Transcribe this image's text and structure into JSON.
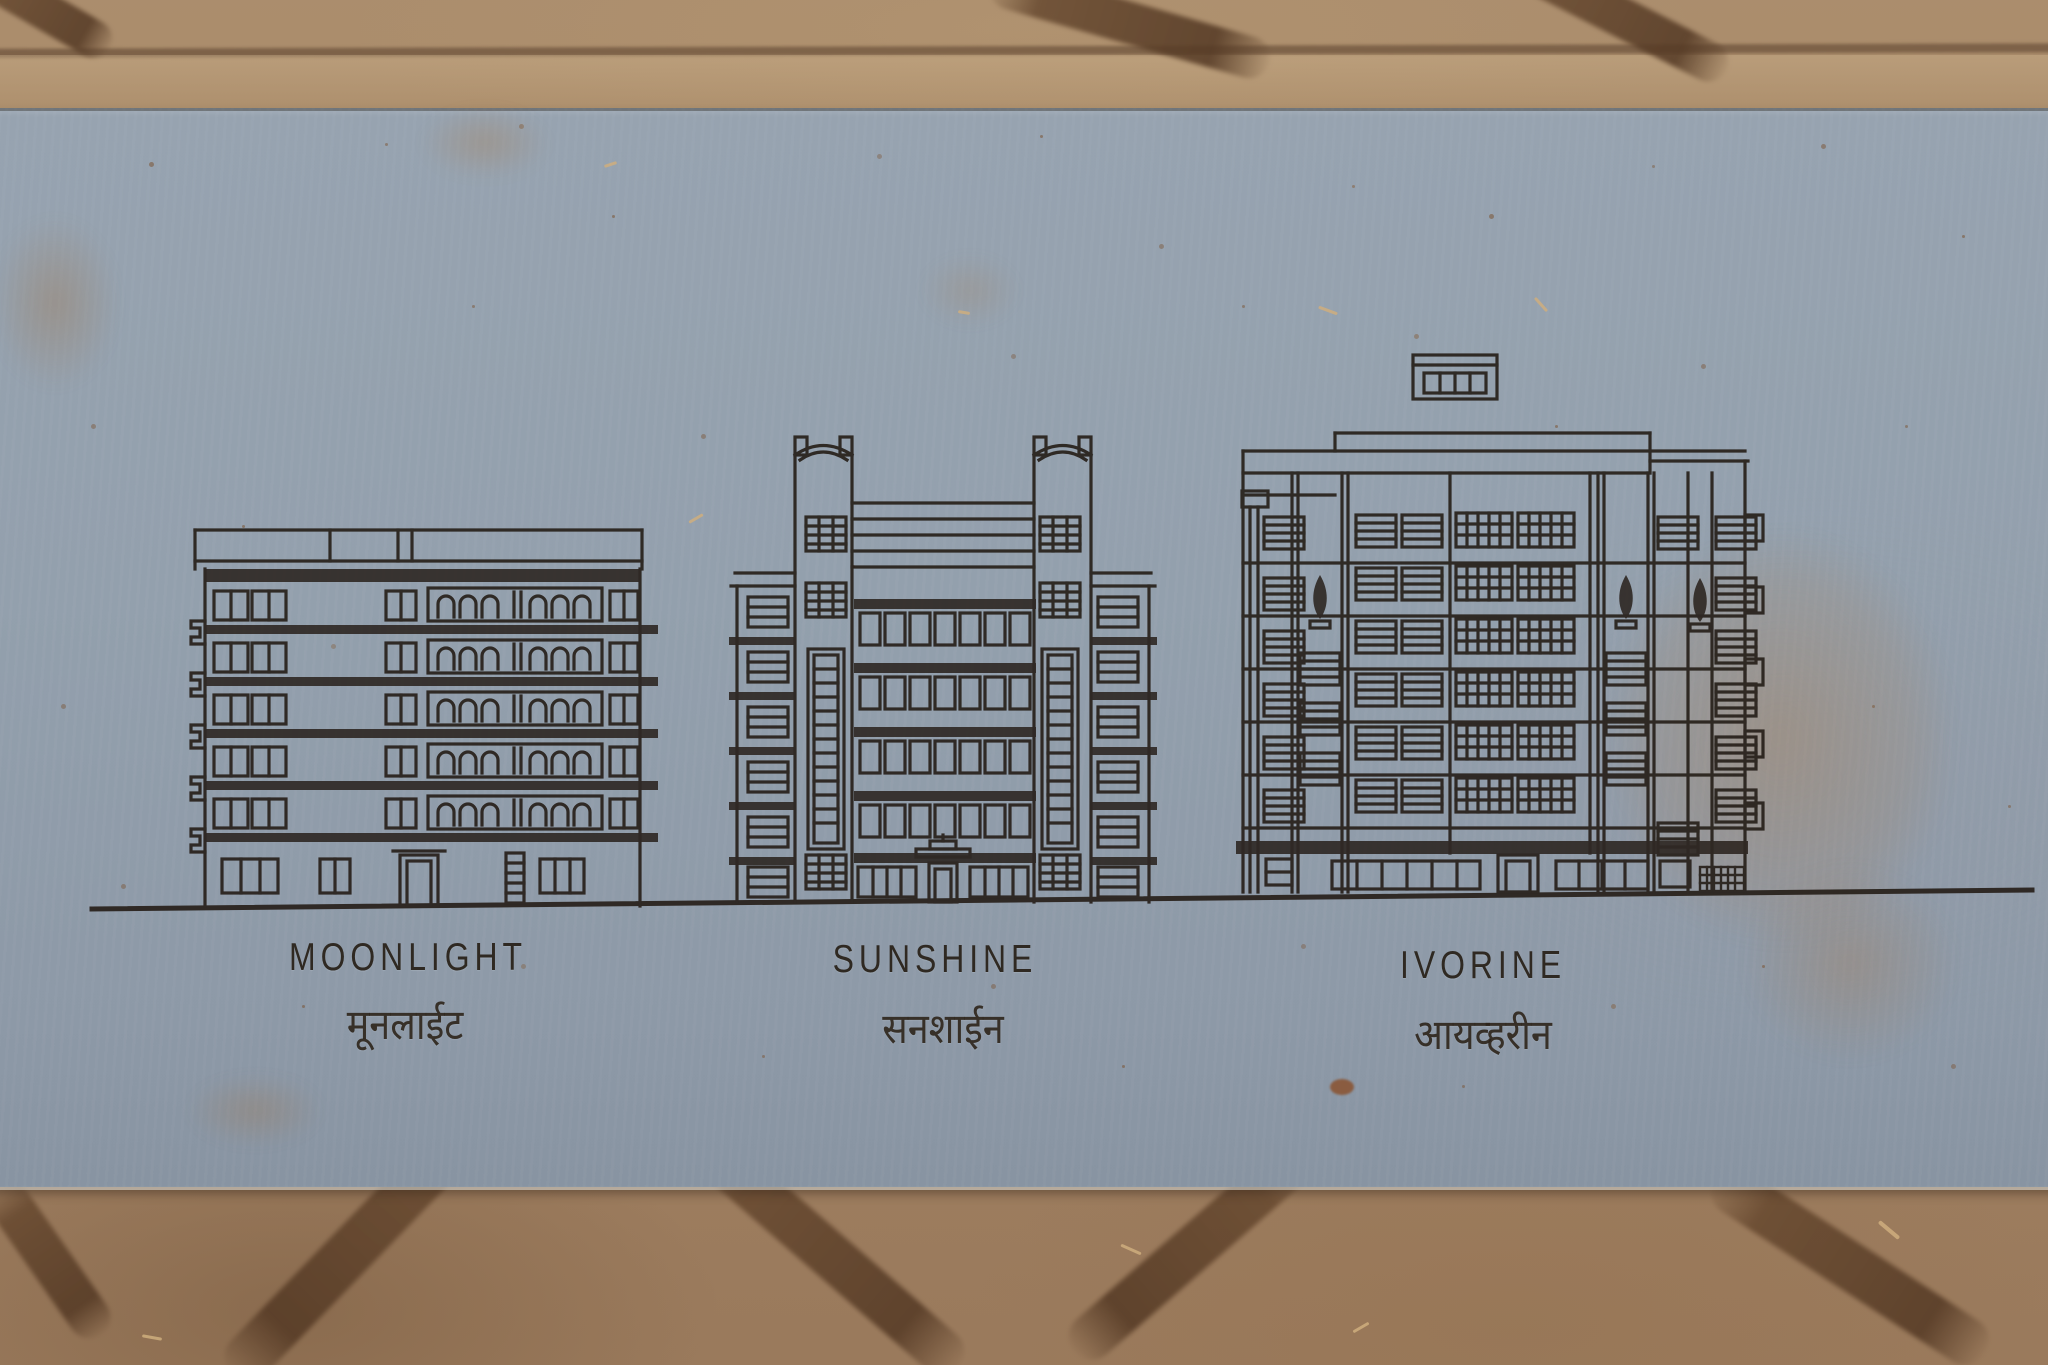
{
  "plaque": {
    "surface_color": "#94a1ae",
    "engraving_color": "#27201a",
    "buildings": [
      {
        "label": "MOONLIGHT",
        "label_devanagari": "मूनलाईट"
      },
      {
        "label": "SUNSHINE",
        "label_devanagari": "सनशाईन"
      },
      {
        "label": "IVORINE",
        "label_devanagari": "आयव्हरीन"
      }
    ]
  },
  "pavement": {
    "stone_color": "#a28365",
    "joint_color": "#64492f"
  }
}
